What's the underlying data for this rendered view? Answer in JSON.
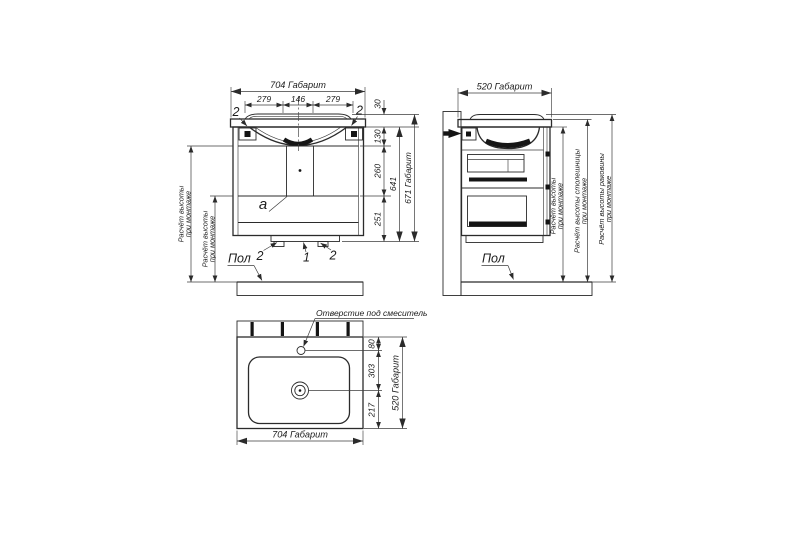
{
  "front_view": {
    "dim_width_total": "704 Габарит",
    "dim_seg_left": "279",
    "dim_seg_center": "146",
    "dim_seg_right": "279",
    "dim_rim_height": "30",
    "dim_top_section": "130",
    "dim_mid_section": "260",
    "dim_bottom_section": "251",
    "dim_body_height": "641",
    "dim_height_total": "671 Габарит",
    "callout_top_left": "2",
    "callout_top_right": "2",
    "callout_foot_left": "2",
    "callout_plinth": "1",
    "callout_foot_right": "2",
    "detail_label": "a",
    "floor_label": "Пол",
    "mount_height_1": {
      "line1": "Расчёт высоты",
      "line2": "при монтаже"
    },
    "mount_height_2": {
      "line1": "Расчёт высоты",
      "line2": "при монтаже"
    }
  },
  "side_view": {
    "dim_depth_total": "520 Габарит",
    "floor_label": "Пол",
    "mount_height": {
      "line1": "Расчёт высоты",
      "line2": "при монтаже"
    },
    "countertop_height": {
      "line1": "Расчёт высоты столешницы",
      "line2": "при монтаже"
    },
    "sink_height": {
      "line1": "Расчёт высоты раковины",
      "line2": "при монтаже"
    }
  },
  "top_view": {
    "faucet_hole_label": "Отверстие под смеситель",
    "dim_hole_offset": "80",
    "dim_hole_to_drain": "303",
    "dim_drain_to_front": "217",
    "dim_depth_total": "520 Габарит",
    "dim_width_total": "704 Габарит"
  }
}
